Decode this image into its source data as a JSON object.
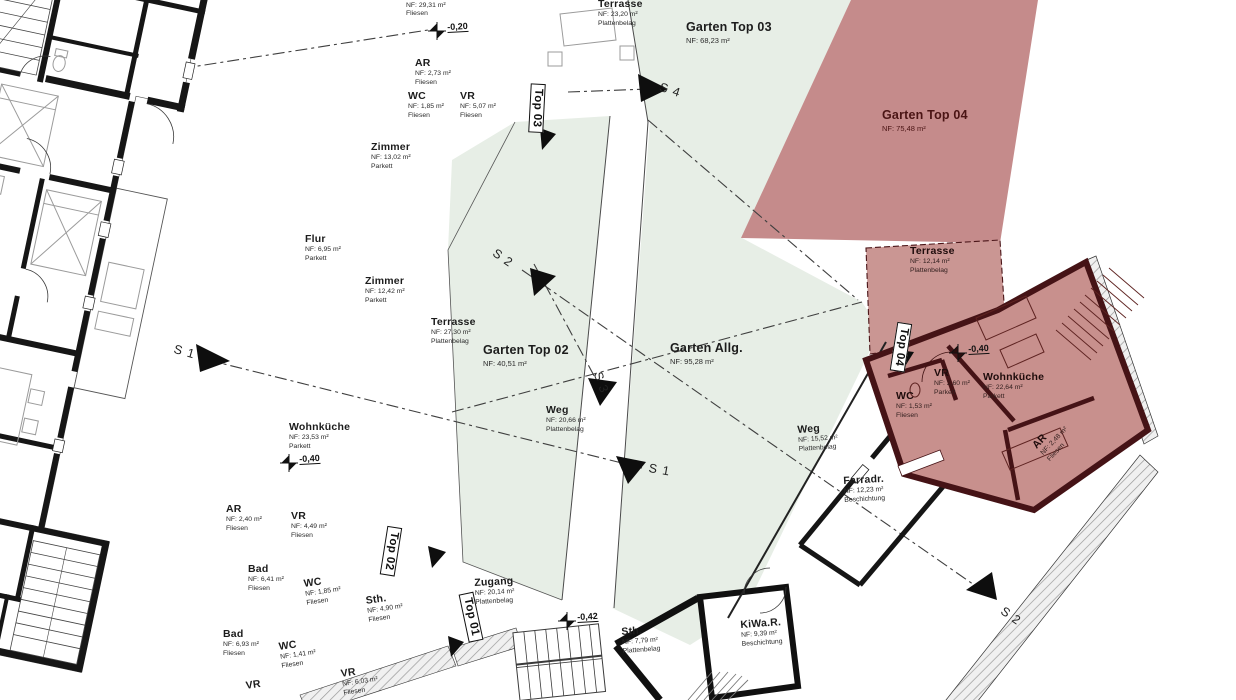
{
  "colors": {
    "garden_green": "#e7eee6",
    "overlay_red_garden": "#c58b8b",
    "overlay_red_unit": "#c8908d",
    "overlay_red_terrace": "#ca9693",
    "red_wall": "#451316",
    "red_text": "#4a1414",
    "wall_ink": "#161616",
    "dashdot_line": "#3f3f3f",
    "hatch_line": "#9a9a9a",
    "furniture_line": "#9b9b9b"
  },
  "labels": [
    {
      "id": "room-top-cut",
      "name": "",
      "lines": [
        "NF: 29,31 m²",
        "Fliesen"
      ],
      "x": 406,
      "y": 2,
      "rot": 0,
      "cls": "room"
    },
    {
      "id": "terrasse-2320",
      "name": "Terrasse",
      "lines": [
        "NF: 23,20 m²",
        "Plattenbelag"
      ],
      "x": 598,
      "y": -2,
      "rot": 0,
      "cls": "room"
    },
    {
      "id": "ar-273",
      "name": "AR",
      "lines": [
        "NF: 2,73 m²",
        "Fliesen"
      ],
      "x": 415,
      "y": 57,
      "rot": 0,
      "cls": "room"
    },
    {
      "id": "wc-185a",
      "name": "WC",
      "lines": [
        "NF: 1,85 m²",
        "Fliesen"
      ],
      "x": 408,
      "y": 90,
      "rot": 0,
      "cls": "room"
    },
    {
      "id": "vr-507",
      "name": "VR",
      "lines": [
        "NF: 5,07 m²",
        "Fliesen"
      ],
      "x": 460,
      "y": 90,
      "rot": 0,
      "cls": "room"
    },
    {
      "id": "zimmer-1302",
      "name": "Zimmer",
      "lines": [
        "NF: 13,02 m²",
        "Parkett"
      ],
      "x": 371,
      "y": 141,
      "rot": 0,
      "cls": "room"
    },
    {
      "id": "flur-695",
      "name": "Flur",
      "lines": [
        "NF: 6,95 m²",
        "Parkett"
      ],
      "x": 305,
      "y": 233,
      "rot": 0,
      "cls": "room"
    },
    {
      "id": "zimmer-1242",
      "name": "Zimmer",
      "lines": [
        "NF: 12,42 m²",
        "Parkett"
      ],
      "x": 365,
      "y": 275,
      "rot": 0,
      "cls": "room"
    },
    {
      "id": "terrasse-2730",
      "name": "Terrasse",
      "lines": [
        "NF: 27,30 m²",
        "Plattenbelag"
      ],
      "x": 431,
      "y": 316,
      "rot": 0,
      "cls": "room"
    },
    {
      "id": "wohnkueche-2353",
      "name": "Wohnküche",
      "lines": [
        "NF: 23,53 m²",
        "Parkett"
      ],
      "x": 289,
      "y": 421,
      "rot": 0,
      "cls": "room"
    },
    {
      "id": "ar-240",
      "name": "AR",
      "lines": [
        "NF: 2,40 m²",
        "Fliesen"
      ],
      "x": 226,
      "y": 503,
      "rot": 0,
      "cls": "room"
    },
    {
      "id": "vr-449",
      "name": "VR",
      "lines": [
        "NF: 4,49 m²",
        "Fliesen"
      ],
      "x": 291,
      "y": 510,
      "rot": 0,
      "cls": "room"
    },
    {
      "id": "bad-641",
      "name": "Bad",
      "lines": [
        "NF: 6,41 m²",
        "Fliesen"
      ],
      "x": 248,
      "y": 563,
      "rot": 0,
      "cls": "room"
    },
    {
      "id": "wc-185b",
      "name": "WC",
      "lines": [
        "NF: 1,85 m²",
        "Fliesen"
      ],
      "x": 303,
      "y": 578,
      "rot": -8,
      "cls": "room"
    },
    {
      "id": "sth-490",
      "name": "Sth.",
      "lines": [
        "NF: 4,90 m²",
        "Fliesen"
      ],
      "x": 365,
      "y": 595,
      "rot": -8,
      "cls": "room"
    },
    {
      "id": "bad-693",
      "name": "Bad",
      "lines": [
        "NF: 6,93 m²",
        "Fliesen"
      ],
      "x": 223,
      "y": 628,
      "rot": 0,
      "cls": "room"
    },
    {
      "id": "wc-141",
      "name": "WC",
      "lines": [
        "NF: 1,41 m²",
        "Fliesen"
      ],
      "x": 278,
      "y": 641,
      "rot": -8,
      "cls": "room"
    },
    {
      "id": "vr-bottom-left",
      "name": "VR",
      "lines": [],
      "x": 245,
      "y": 680,
      "rot": -8,
      "cls": "room"
    },
    {
      "id": "vr-603",
      "name": "VR",
      "lines": [
        "NF: 6,03 m²",
        "Fliesen"
      ],
      "x": 340,
      "y": 668,
      "rot": -8,
      "cls": "room"
    },
    {
      "id": "zugang-2014",
      "name": "Zugang",
      "lines": [
        "NF: 20,14 m²",
        "Plattenbelag"
      ],
      "x": 474,
      "y": 577,
      "rot": -3,
      "cls": "room"
    },
    {
      "id": "sth-779",
      "name": "Sth.",
      "lines": [
        "NF: 7,79 m²",
        "Plattenbelag"
      ],
      "x": 621,
      "y": 626,
      "rot": -4,
      "cls": "room"
    },
    {
      "id": "kiwa-939",
      "name": "KiWa.R.",
      "lines": [
        "NF: 9,39 m²",
        "Beschichtung"
      ],
      "x": 740,
      "y": 619,
      "rot": -4,
      "cls": "room"
    },
    {
      "id": "weg-1552",
      "name": "Weg",
      "lines": [
        "NF: 15,52 m²",
        "Plattenbelag"
      ],
      "x": 797,
      "y": 424,
      "rot": -4,
      "cls": "room"
    },
    {
      "id": "farradr-1223",
      "name": "Farradr.",
      "lines": [
        "NF: 12,23 m²",
        "Beschichtung"
      ],
      "x": 843,
      "y": 475,
      "rot": -3,
      "cls": "room"
    },
    {
      "id": "garten-top02",
      "name": "Garten Top 02",
      "lines": [
        "NF: 40,51 m²"
      ],
      "x": 483,
      "y": 343,
      "rot": 0,
      "cls": "garden"
    },
    {
      "id": "weg-2066",
      "name": "Weg",
      "lines": [
        "NF: 20,66 m²",
        "Plattenbelag"
      ],
      "x": 546,
      "y": 404,
      "rot": 0,
      "cls": "room"
    },
    {
      "id": "garten-allg",
      "name": "Garten Allg.",
      "lines": [
        "NF: 95,28 m²"
      ],
      "x": 670,
      "y": 341,
      "rot": 0,
      "cls": "garden"
    },
    {
      "id": "garten-top03",
      "name": "Garten Top 03",
      "lines": [
        "NF: 68,23 m²"
      ],
      "x": 686,
      "y": 20,
      "rot": 0,
      "cls": "garden"
    },
    {
      "id": "garten-top04",
      "name": "Garten Top 04",
      "lines": [
        "NF: 75,48 m²"
      ],
      "x": 882,
      "y": 108,
      "rot": 0,
      "cls": "garden-red"
    },
    {
      "id": "terrasse-1214",
      "name": "Terrasse",
      "lines": [
        "NF: 12,14 m²",
        "Plattenbelag"
      ],
      "x": 910,
      "y": 245,
      "rot": 0,
      "cls": "room-red"
    },
    {
      "id": "vr-260",
      "name": "VR",
      "lines": [
        "NF: 2,60 m²",
        "Parkett"
      ],
      "x": 934,
      "y": 367,
      "rot": 0,
      "cls": "room-red"
    },
    {
      "id": "wc-153",
      "name": "WC",
      "lines": [
        "NF: 1,53 m²",
        "Fliesen"
      ],
      "x": 896,
      "y": 390,
      "rot": 0,
      "cls": "room-red"
    },
    {
      "id": "wohnkueche-2264",
      "name": "Wohnküche",
      "lines": [
        "NF: 22,64 m²",
        "Parkett"
      ],
      "x": 983,
      "y": 371,
      "rot": 0,
      "cls": "room-red"
    },
    {
      "id": "ar-red",
      "name": "AR",
      "lines": [
        "NF: 2,48 m²",
        "Fliesen"
      ],
      "x": 1030,
      "y": 443,
      "rot": -47,
      "cls": "room-red"
    }
  ],
  "units": [
    {
      "id": "unit-top03",
      "label": "Top 03",
      "x": 537,
      "y": 108,
      "rot": 93
    },
    {
      "id": "unit-top02",
      "label": "Top 02",
      "x": 391,
      "y": 551,
      "rot": 99
    },
    {
      "id": "unit-top01",
      "label": "Top 01",
      "x": 471,
      "y": 617,
      "rot": 78
    },
    {
      "id": "unit-top04",
      "label": "Top 04",
      "x": 901,
      "y": 347,
      "rot": 99
    }
  ],
  "sections": [
    {
      "id": "section-s1-left",
      "label": "S 1",
      "x": 176,
      "y": 342,
      "rot": 16
    },
    {
      "id": "section-s2-top",
      "label": "S 2",
      "x": 498,
      "y": 246,
      "rot": 35
    },
    {
      "id": "section-s3-mid",
      "label": "S 3",
      "x": 604,
      "y": 370,
      "rot": 70
    },
    {
      "id": "section-s1-mid",
      "label": "S 1",
      "x": 650,
      "y": 461,
      "rot": 10
    },
    {
      "id": "section-s4-top",
      "label": "S 4",
      "x": 662,
      "y": 80,
      "rot": 18
    },
    {
      "id": "section-s2-bottom",
      "label": "S 2",
      "x": 1006,
      "y": 604,
      "rot": 35
    }
  ],
  "levels": [
    {
      "id": "level-020",
      "value": "-0,20",
      "x": 447,
      "y": 22,
      "rot": -3
    },
    {
      "id": "level-040-left",
      "value": "-0,40",
      "x": 299,
      "y": 454,
      "rot": -3
    },
    {
      "id": "level-042",
      "value": "-0,42",
      "x": 577,
      "y": 612,
      "rot": -3
    },
    {
      "id": "level-040-right",
      "value": "-0,40",
      "x": 968,
      "y": 344,
      "rot": -3
    }
  ]
}
